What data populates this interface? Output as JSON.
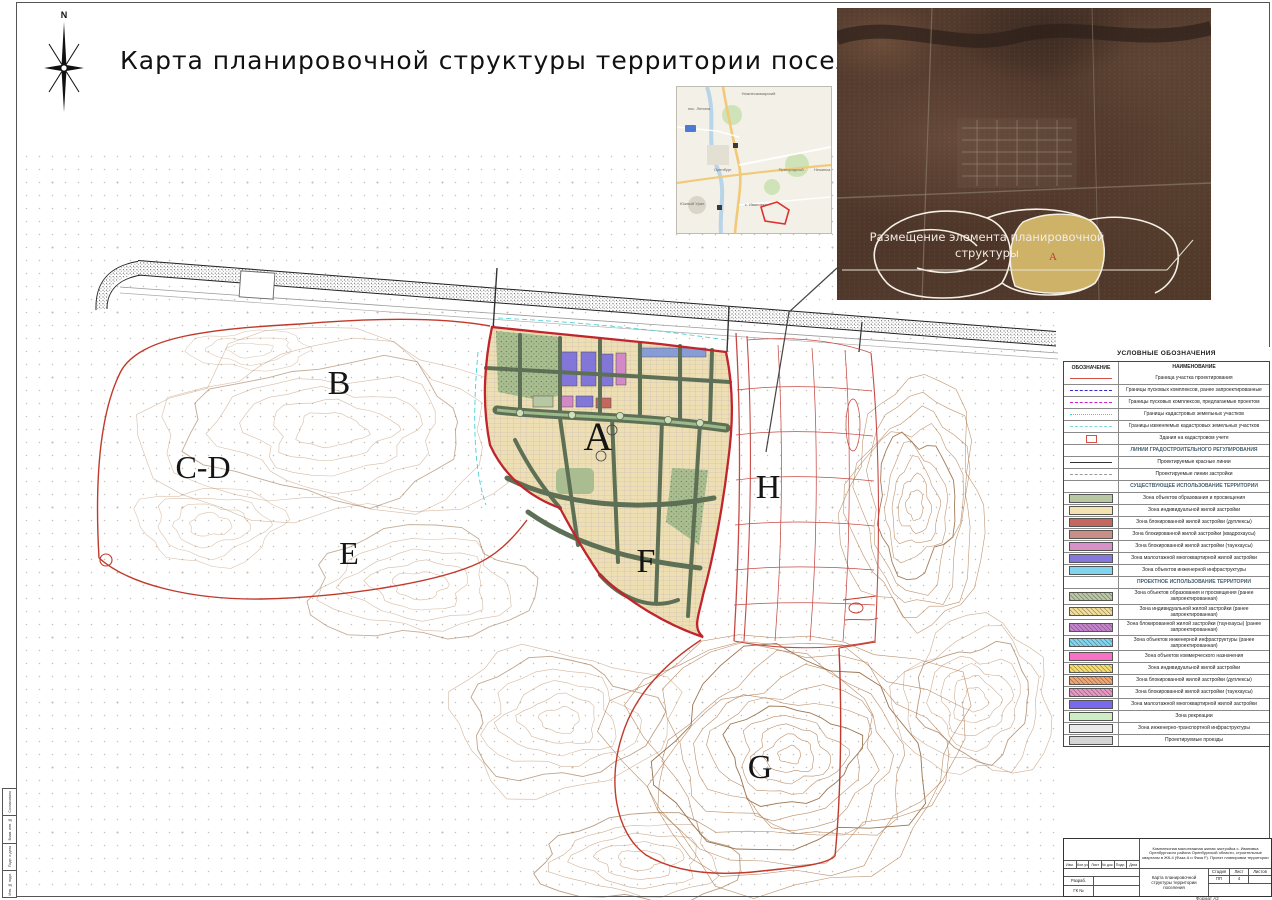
{
  "page": {
    "title": "Карта планировочной структуры территории поселения",
    "north_label": "N",
    "format_label": "Формат А2"
  },
  "satellite": {
    "caption_line1": "Размещение элемента планировочной",
    "caption_line2": "структуры",
    "area_label": "А"
  },
  "inset_map": {
    "labels": [
      {
        "text": "Нижнесакмарский",
        "x": 42,
        "y": 3
      },
      {
        "text": "пос. Ленина",
        "x": 7,
        "y": 13
      },
      {
        "text": "Оренбург",
        "x": 24,
        "y": 55
      },
      {
        "text": "Пригородный",
        "x": 66,
        "y": 55
      },
      {
        "text": "Нежинка",
        "x": 89,
        "y": 55
      },
      {
        "text": "с. Ивановка",
        "x": 44,
        "y": 79
      },
      {
        "text": "Южный Урал",
        "x": 2,
        "y": 78
      }
    ]
  },
  "map": {
    "zone_labels": [
      {
        "id": "A",
        "x": 598,
        "y": 450,
        "size": 40
      },
      {
        "id": "B",
        "x": 339,
        "y": 394,
        "size": 34
      },
      {
        "id": "C-D",
        "x": 203,
        "y": 478,
        "size": 32
      },
      {
        "id": "E",
        "x": 349,
        "y": 564,
        "size": 32
      },
      {
        "id": "F",
        "x": 646,
        "y": 572,
        "size": 34
      },
      {
        "id": "G",
        "x": 760,
        "y": 778,
        "size": 34
      },
      {
        "id": "H",
        "x": 768,
        "y": 498,
        "size": 34
      }
    ]
  },
  "legend": {
    "title": "УСЛОВНЫЕ ОБОЗНАЧЕНИЯ",
    "col_symbol": "ОБОЗНАЧЕНИЕ",
    "col_name": "НАИМЕНОВАНИЕ",
    "rows": [
      {
        "sym": "line",
        "style": "solid",
        "color": "#d94f43",
        "label": "Граница участка проектирования"
      },
      {
        "sym": "line",
        "style": "dashed",
        "color": "#2b2bd0",
        "label": "Границы пусковых комплексов, ранее запроектированные"
      },
      {
        "sym": "line",
        "style": "dashed",
        "color": "#cc22cc",
        "label": "Границы пусковых комплексов, предлагаемые проектом"
      },
      {
        "sym": "line",
        "style": "dashdot",
        "color": "#45cfd6",
        "label": "Границы кадастровых земельных участков"
      },
      {
        "sym": "line",
        "style": "dashed",
        "color": "#7fd9dd",
        "label": "Границы изменяемых кадастровых земельных участков"
      },
      {
        "sym": "rect",
        "color": "#d94f43",
        "label": "Здания на кадастровом учете"
      },
      {
        "sym": "none",
        "section": true,
        "label": "ЛИНИИ ГРАДОСТРОИТЕЛЬНОГО РЕГУЛИРОВАНИЯ"
      },
      {
        "sym": "line",
        "style": "solid",
        "color": "#333333",
        "label": "Проектируемые красные линии"
      },
      {
        "sym": "line",
        "style": "dashed",
        "color": "#9a9a9a",
        "label": "Проектируемые линии застройки"
      },
      {
        "sym": "none",
        "section": true,
        "label": "СУЩЕСТВУЮЩЕЕ ИСПОЛЬЗОВАНИЕ ТЕРРИТОРИИ"
      },
      {
        "sym": "swatch",
        "color": "#b7c8a2",
        "label": "Зона объектов образования и просвещения"
      },
      {
        "sym": "swatch",
        "color": "#f4e2b0",
        "label": "Зона индивидуальной жилой застройки"
      },
      {
        "sym": "swatch",
        "color": "#c4675e",
        "label": "Зона блокированной жилой застройки (дуплексы)"
      },
      {
        "sym": "swatch",
        "color": "#c98f86",
        "label": "Зона блокированной жилой застройки (квадрохаусы)"
      },
      {
        "sym": "swatch",
        "color": "#d891c6",
        "label": "Зона блокированной жилой застройки (таунхаусы)"
      },
      {
        "sym": "swatch",
        "color": "#8577dc",
        "label": "Зона малоэтажной многоквартирной жилой застройки"
      },
      {
        "sym": "swatch",
        "color": "#7fd6ee",
        "label": "Зона объектов инженерной инфраструктуры"
      },
      {
        "sym": "none",
        "section": true,
        "label": "ПРОЕКТНОЕ ИСПОЛЬЗОВАНИЕ ТЕРРИТОРИИ"
      },
      {
        "sym": "hatch",
        "color": "#b7c8a2",
        "label": "Зона объектов образования и просвещения (ранее запроектированная)"
      },
      {
        "sym": "hatch",
        "color": "#f1de9a",
        "label": "Зона индивидуальной жилой застройки (ранее запроектированная)"
      },
      {
        "sym": "hatch",
        "color": "#c583cd",
        "label": "Зона блокированной жилой застройки (таунхаусы) (ранее запроектированная)"
      },
      {
        "sym": "hatch",
        "color": "#7fd6ee",
        "label": "Зона объектов инженерной инфраструктуры (ранее запроектированная)"
      },
      {
        "sym": "swatch",
        "color": "#f871c4",
        "label": "Зона объектов коммерческого назначения"
      },
      {
        "sym": "hatch",
        "color": "#f3dd6e",
        "label": "Зона индивидуальной жилой застройки"
      },
      {
        "sym": "hatch",
        "color": "#efa673",
        "label": "Зона блокированной жилой застройки (дуплексы)"
      },
      {
        "sym": "hatch",
        "color": "#e697c6",
        "label": "Зона блокированной жилой застройки (таунхаусы)"
      },
      {
        "sym": "swatch",
        "color": "#7a68ee",
        "label": "Зона малоэтажной многоквартирной жилой застройки"
      },
      {
        "sym": "swatch",
        "color": "#cdeec4",
        "label": "Зона рекреации"
      },
      {
        "sym": "swatch",
        "color": "#ebebeb",
        "label": "Зона инженерно-транспортной инфраструктуры"
      },
      {
        "sym": "swatch",
        "color": "#d6d6d6",
        "label": "Проектируемые проезды"
      }
    ]
  },
  "title_block": {
    "project": "Комплексная малоэтажная жилая застройка с. Ивановка Оренбургского района Оренбургской области, строительные кварталы в ЖК-4 (Фаза А и Фаза F). Проект планировки территории",
    "doc_name": "Карта планировочной структуры территории поселения",
    "header_cells": [
      "Изм.",
      "Кол.уч",
      "Лист",
      "№ док.",
      "Подп.",
      "Дата"
    ],
    "razrab_label": "Разраб.",
    "gk_label": "ГК №",
    "stage_label": "Стадия",
    "sheet_label": "Лист",
    "sheets_label": "Листов",
    "stage_value": "ПП",
    "sheet_value": "4",
    "sheets_value": ""
  },
  "side_strip": {
    "cells": [
      "Согласовано",
      "Взам. инв. №",
      "Подп. и дата",
      "Инв. № подл."
    ]
  }
}
